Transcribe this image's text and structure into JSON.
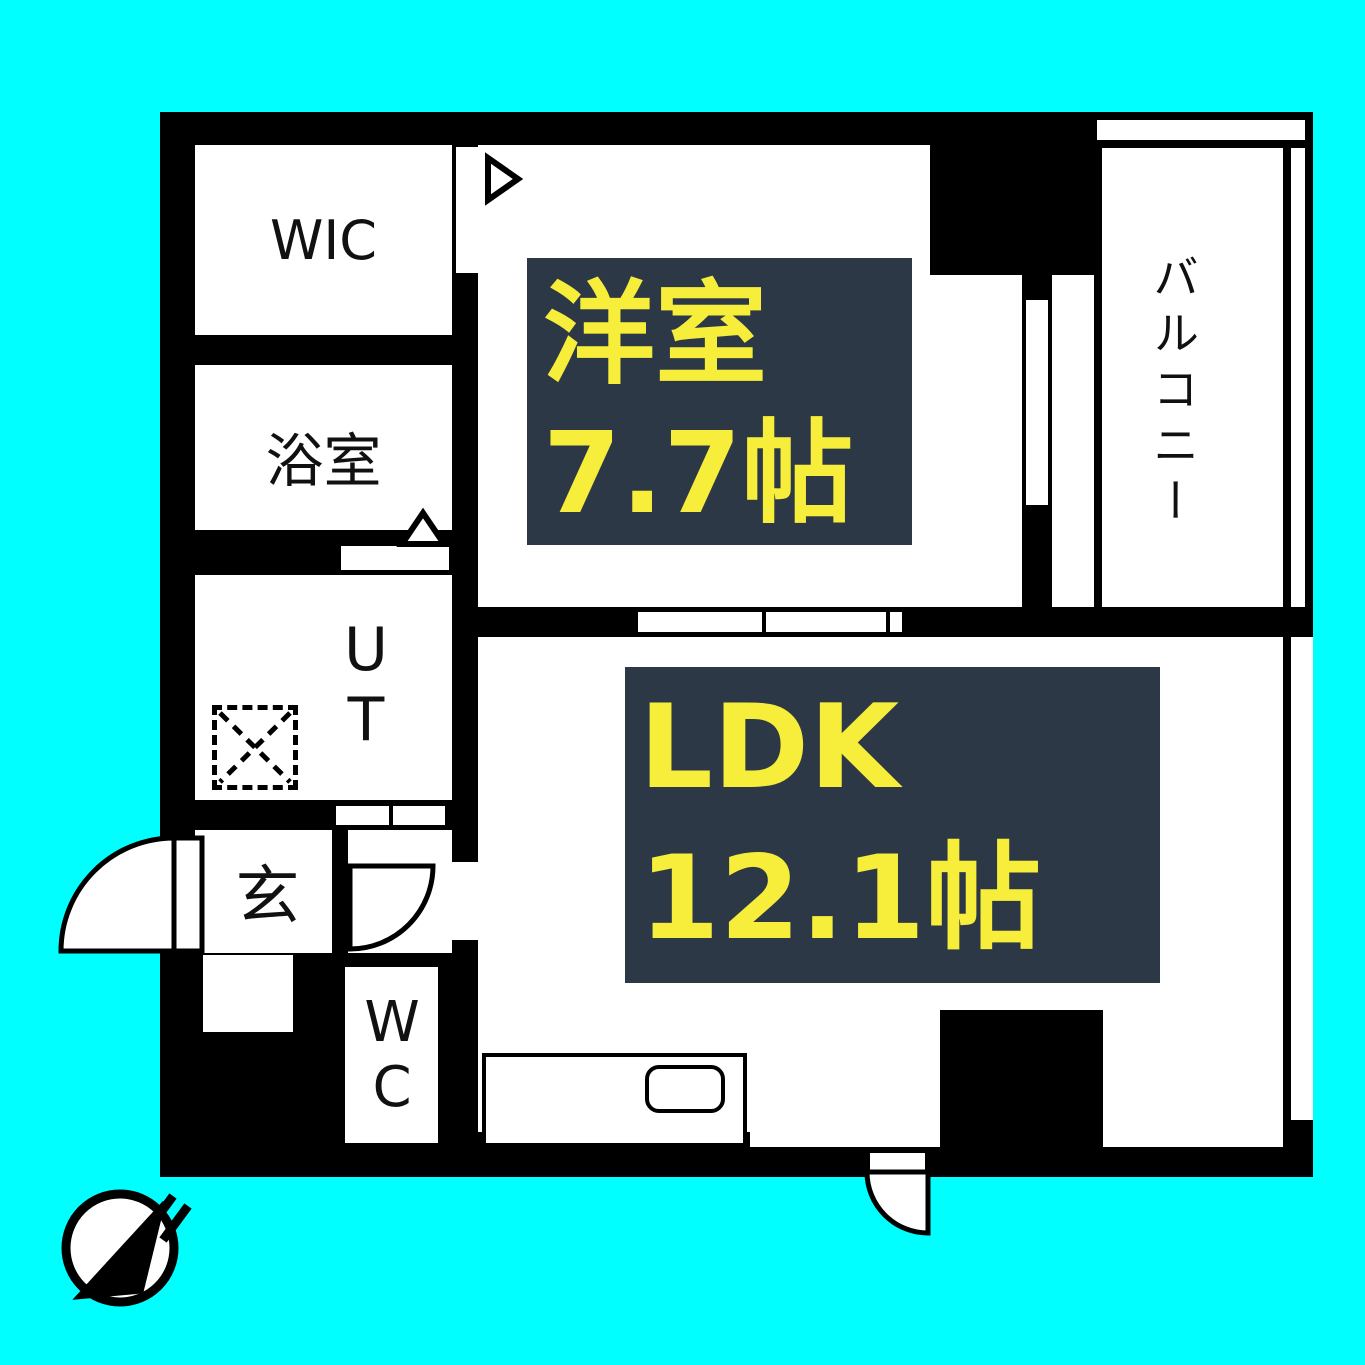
{
  "title": "1LDK apartment floor plan",
  "colors": {
    "background": "#00ffff",
    "wall": "#000000",
    "floor": "#ffffff",
    "label_box": "#2d3847",
    "label_text": "#f6ee3a",
    "room_text": "#111111"
  },
  "rooms": {
    "wic": {
      "label": "WIC"
    },
    "bath": {
      "label": "浴室"
    },
    "utility": {
      "label": "UT"
    },
    "entrance": {
      "label": "玄"
    },
    "toilet": {
      "label": "WC"
    },
    "balcony": {
      "label": "バルコニー"
    },
    "western_room": {
      "label": "洋室",
      "size": "7.7帖"
    },
    "ldk": {
      "label": "LDK",
      "size": "12.1帖"
    }
  },
  "icons": {
    "compass": "north-compass-needle-pointing-upper-right",
    "washer": "washing-machine-dashed-square-x",
    "sink": "kitchen-sink-rounded-rect",
    "door_arcs": "quarter-circle-door-swings",
    "triangles": "door-opening-direction-markers"
  }
}
